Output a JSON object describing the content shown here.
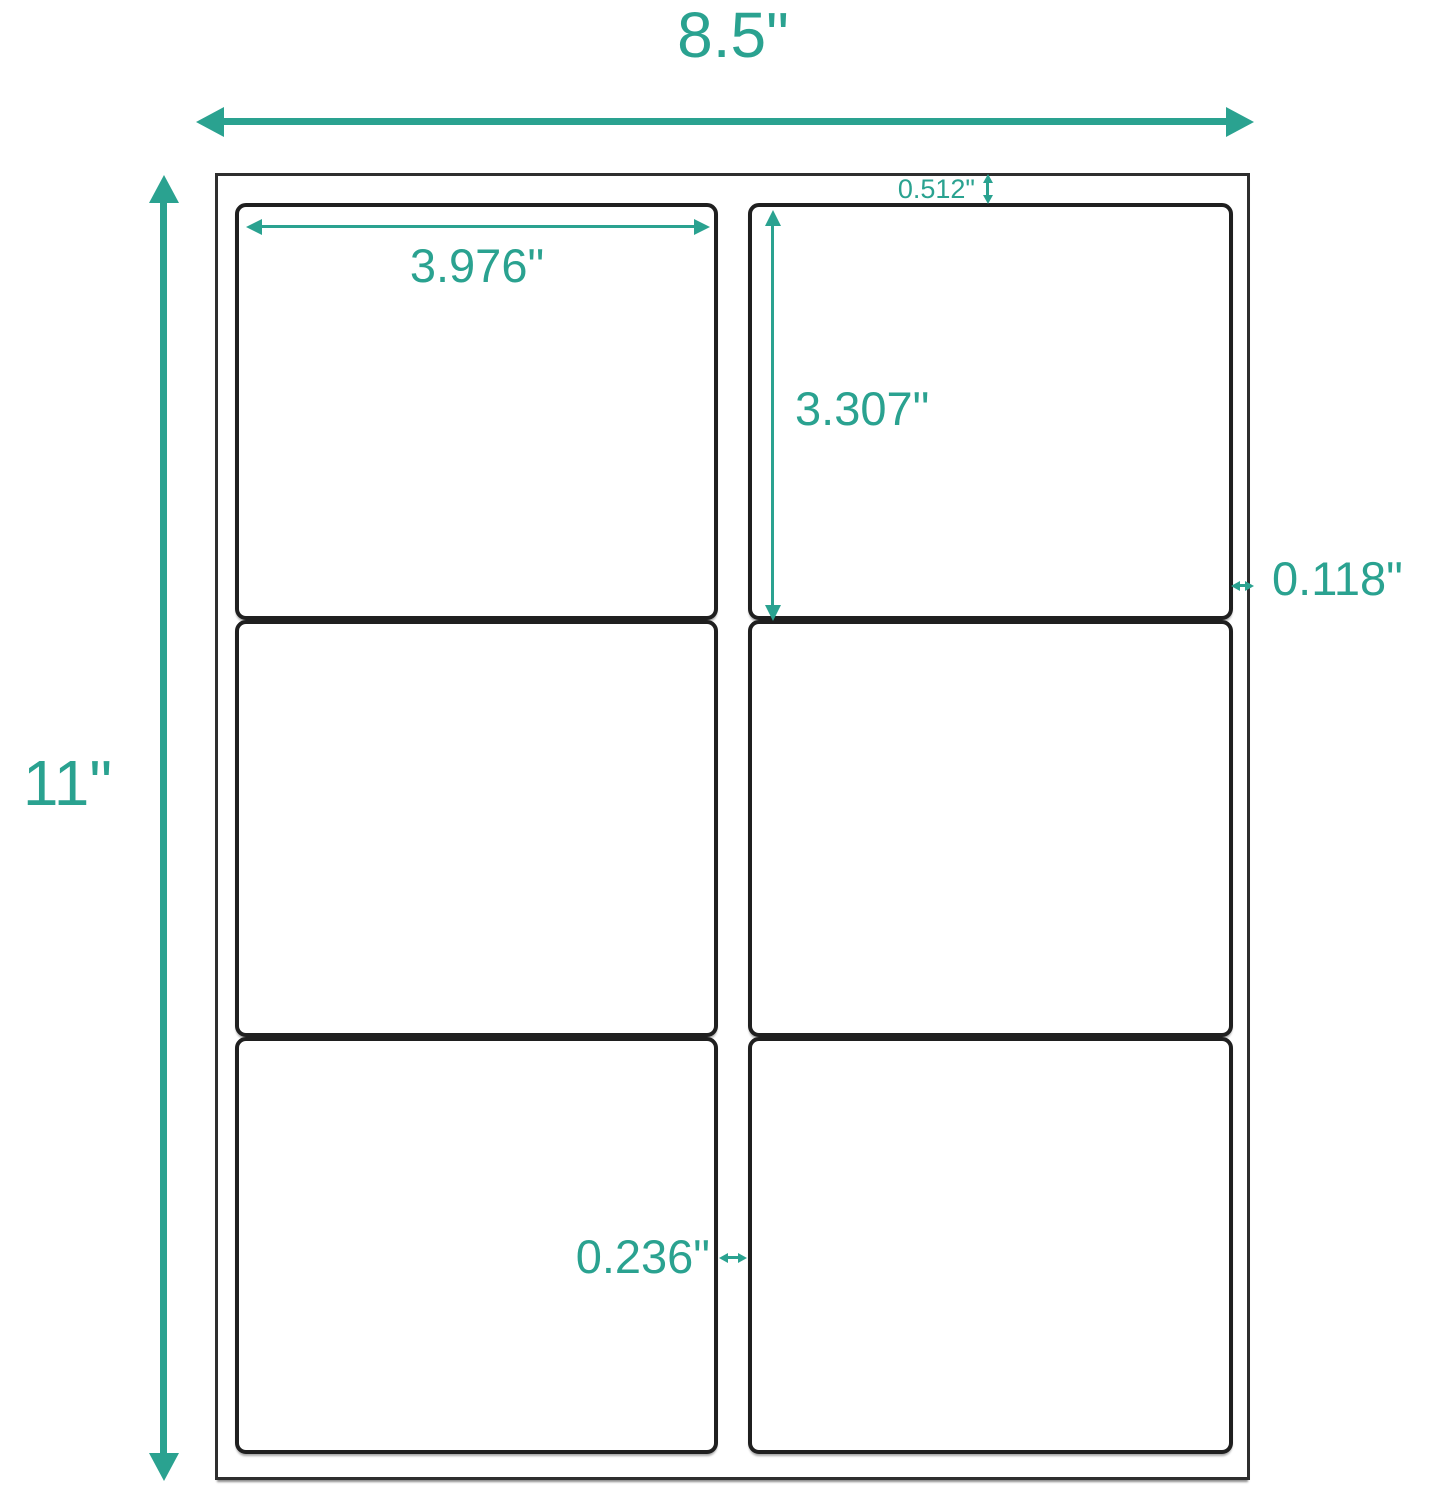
{
  "accent_color": "#2aa290",
  "line_color": "#1f1f1f",
  "diagram_type": "label-sheet-dimensions",
  "grid": {
    "rows": 3,
    "columns": 2,
    "label_count": 6
  },
  "dimensions": {
    "sheet_width": "8.5\"",
    "sheet_height": "11\"",
    "label_width": "3.976\"",
    "label_height": "3.307\"",
    "top_margin": "0.512\"",
    "side_margin": "0.118\"",
    "column_gap": "0.236\""
  }
}
